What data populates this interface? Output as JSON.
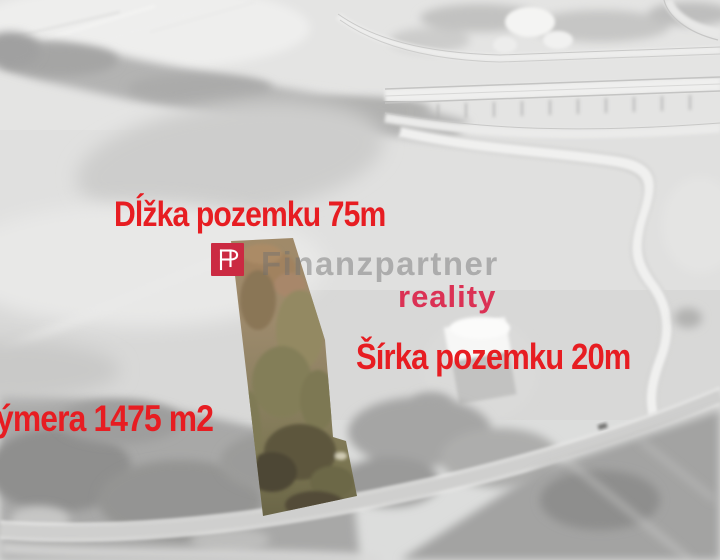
{
  "colors": {
    "annotation": "#e71d22",
    "logo": "#cb2a42",
    "division": "#db3154",
    "watermark": "#6f6f6f",
    "plot_top": "#a08a69",
    "plot_mid": "#8d8162",
    "plot_bottom": "#6a6547"
  },
  "branding": {
    "monogram": "FP",
    "company_name": "Finanzpartner",
    "division_label": "reality"
  },
  "annotations": {
    "length_label": "Dĺžka pozemku 75m",
    "width_label": "Šírka pozemku 20m",
    "area_label_visible": "ýmera 1475 m2"
  }
}
